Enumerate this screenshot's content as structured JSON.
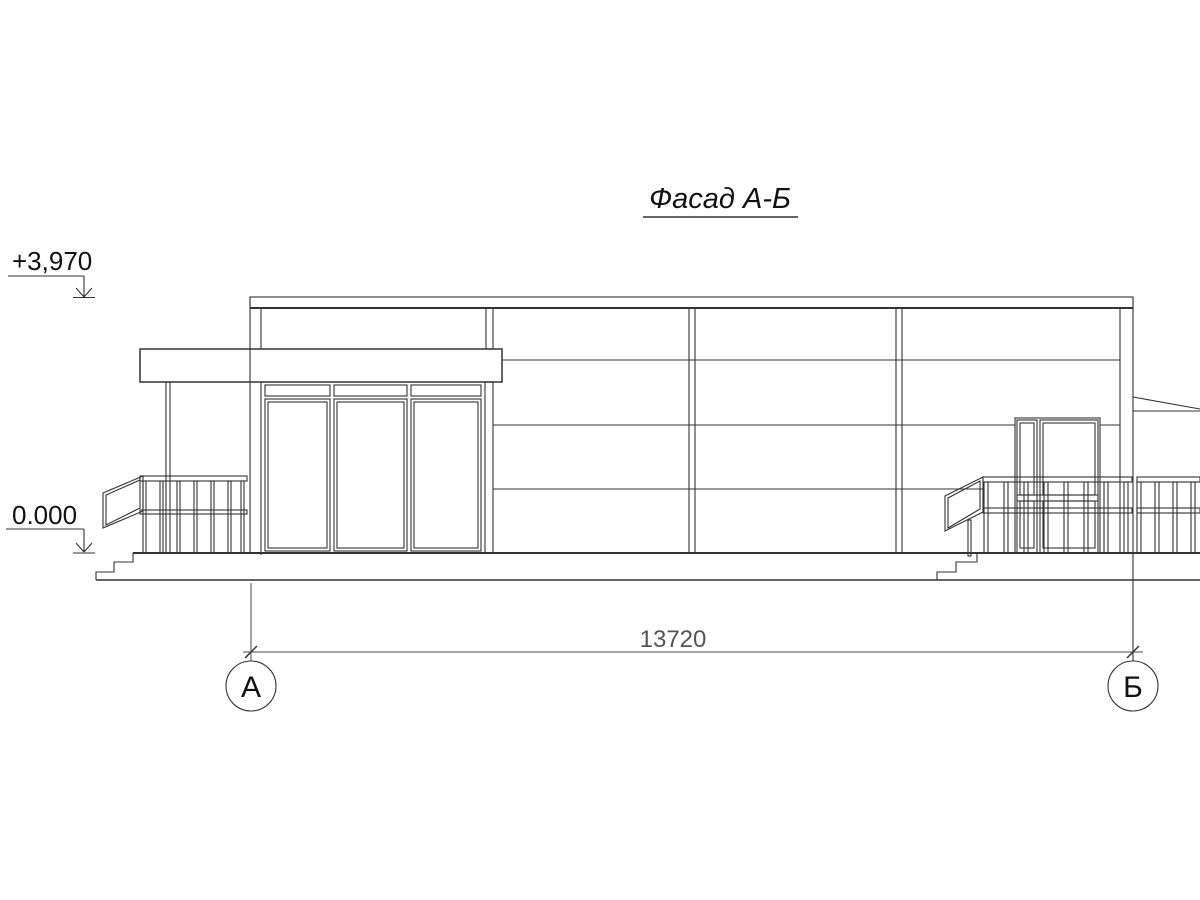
{
  "title": "Фасад А-Б",
  "levels": {
    "roof": "+3,970",
    "ground": "0.000"
  },
  "dimension": {
    "overall": "13720"
  },
  "axes": {
    "left": "А",
    "right": "Б"
  },
  "colors": {
    "line": "#333333",
    "dim_text": "#555555",
    "background": "#ffffff"
  }
}
